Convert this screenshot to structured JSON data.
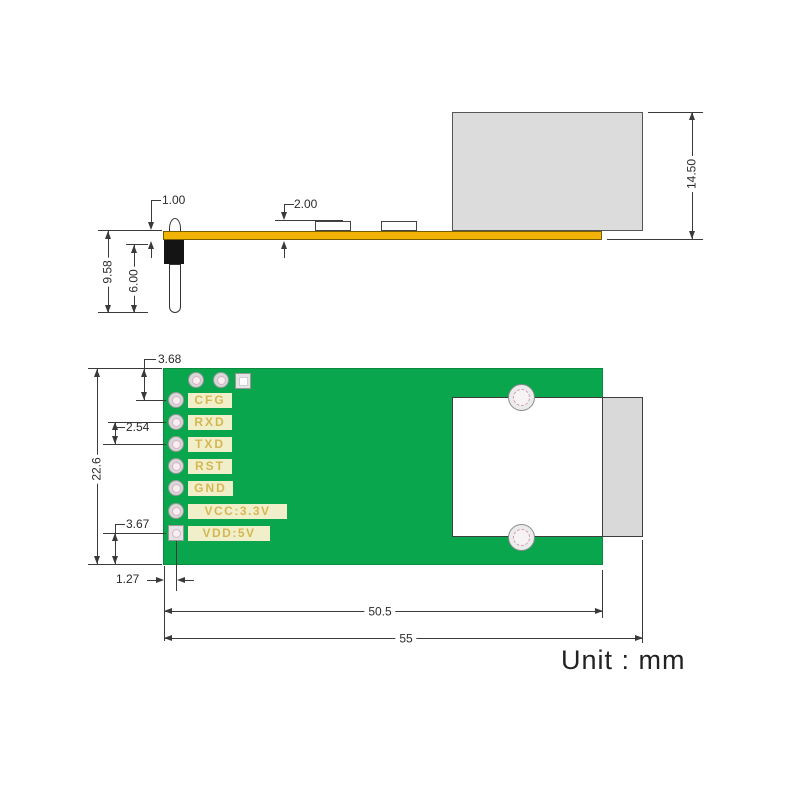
{
  "unit_note": "Unit : mm",
  "colors": {
    "board_yellow": "#f2b206",
    "board_green": "#0aa64e",
    "connector_gray": "#dcdcdc",
    "silkscreen_bg": "#f1efca",
    "silkscreen_text": "#d4b752",
    "dimension_line": "#3a3a3a"
  },
  "side_view": {
    "description": "PCB module side profile with pin header and RJ45 connector",
    "dimensions": {
      "board_thickness": "1.00",
      "component_height": "2.00",
      "overall_height": "9.58",
      "pin_length": "6.00",
      "connector_height": "14.50"
    }
  },
  "top_view": {
    "description": "PCB module top view with pin pads and RJ45 footprint",
    "pins": [
      {
        "label": "CFG"
      },
      {
        "label": "RXD"
      },
      {
        "label": "TXD"
      },
      {
        "label": "RST"
      },
      {
        "label": "GND"
      },
      {
        "label": "VCC:3.3V"
      },
      {
        "label": "VDD:5V"
      }
    ],
    "dimensions": {
      "pin1_from_top_edge": "3.68",
      "pin_pitch": "2.54",
      "board_width": "22.6",
      "pin7_from_bottom_edge": "3.67",
      "pins_from_left_edge": "1.27",
      "board_length": "50.5",
      "overall_length": "55"
    }
  }
}
